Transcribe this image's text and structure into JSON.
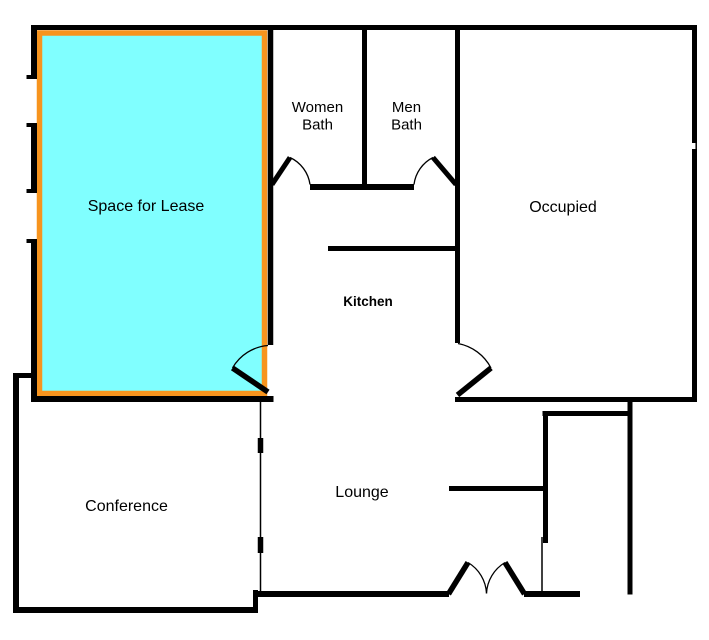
{
  "document": {
    "title": "Office Floor Plan"
  },
  "colors": {
    "wall": "#000000",
    "lease_fill": "#80FFFF",
    "lease_border": "#F7941E",
    "background": "#FFFFFF",
    "label": "#000000"
  },
  "rooms": {
    "lease": {
      "label": "Space for Lease"
    },
    "women_bath": {
      "line1": "Women",
      "line2": "Bath"
    },
    "men_bath": {
      "line1": "Men",
      "line2": "Bath"
    },
    "occupied": {
      "label": "Occupied"
    },
    "kitchen": {
      "label": "Kitchen"
    },
    "conference": {
      "label": "Conference"
    },
    "lounge": {
      "label": "Lounge"
    }
  }
}
